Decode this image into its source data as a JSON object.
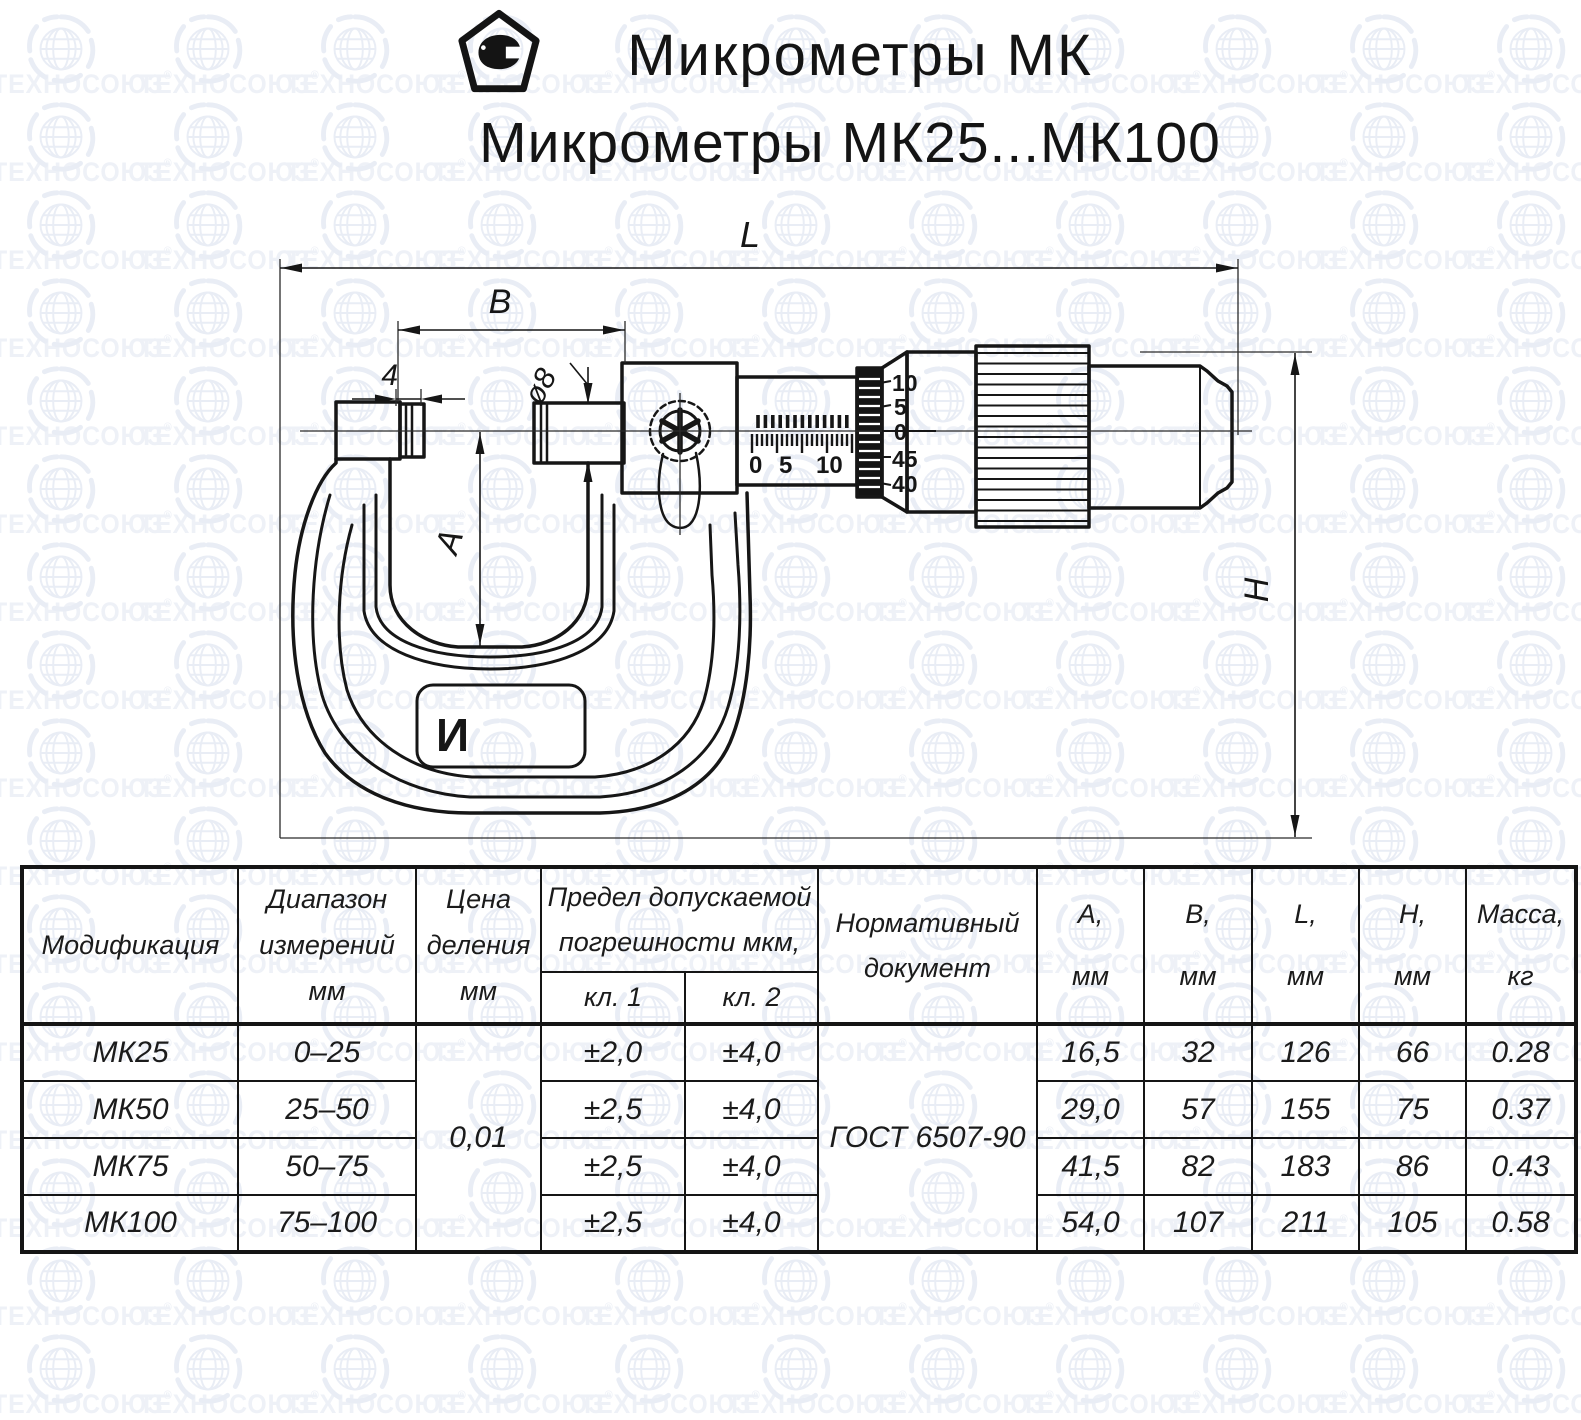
{
  "watermark": {
    "text": "ТЕХНОСОЮЗ",
    "registered": "®"
  },
  "header": {
    "title_line1": "Микрометры МК",
    "title_line2": "Микрометры МК25...МК100"
  },
  "drawing": {
    "dim_L": "L",
    "dim_B": "B",
    "dim_4": "4",
    "dim_d8": "ø8",
    "dim_A": "A",
    "dim_H": "H",
    "badge_mark": "И",
    "sleeve_scale": [
      "0",
      "5",
      "10"
    ],
    "thimble_scale": [
      "10",
      "5",
      "0",
      "45",
      "40"
    ]
  },
  "table": {
    "headers": {
      "modification": "Модификация",
      "range": [
        "Диапазон",
        "измерений",
        "мм"
      ],
      "division": [
        "Цена",
        "деления",
        "мм"
      ],
      "error_limit": [
        "Предел допускаемой",
        "погрешности мкм,"
      ],
      "class1": "кл. 1",
      "class2": "кл. 2",
      "normative": [
        "Нормативный",
        "документ"
      ],
      "A": [
        "А,",
        "мм"
      ],
      "B": [
        "В,",
        "мм"
      ],
      "L": [
        "L,",
        "мм"
      ],
      "H": [
        "Н,",
        "мм"
      ],
      "mass": [
        "Масса,",
        "кг"
      ]
    },
    "division_value": "0,01",
    "normative_value": "ГОСТ 6507-90",
    "rows": [
      {
        "model": "МК25",
        "range": "0–25",
        "cl1": "±2,0",
        "cl2": "±4,0",
        "A": "16,5",
        "B": "32",
        "L": "126",
        "H": "66",
        "mass": "0.28"
      },
      {
        "model": "МК50",
        "range": "25–50",
        "cl1": "±2,5",
        "cl2": "±4,0",
        "A": "29,0",
        "B": "57",
        "L": "155",
        "H": "75",
        "mass": "0.37"
      },
      {
        "model": "МК75",
        "range": "50–75",
        "cl1": "±2,5",
        "cl2": "±4,0",
        "A": "41,5",
        "B": "82",
        "L": "183",
        "H": "86",
        "mass": "0.43"
      },
      {
        "model": "МК100",
        "range": "75–100",
        "cl1": "±2,5",
        "cl2": "±4,0",
        "A": "54,0",
        "B": "107",
        "L": "211",
        "H": "105",
        "mass": "0.58"
      }
    ]
  }
}
